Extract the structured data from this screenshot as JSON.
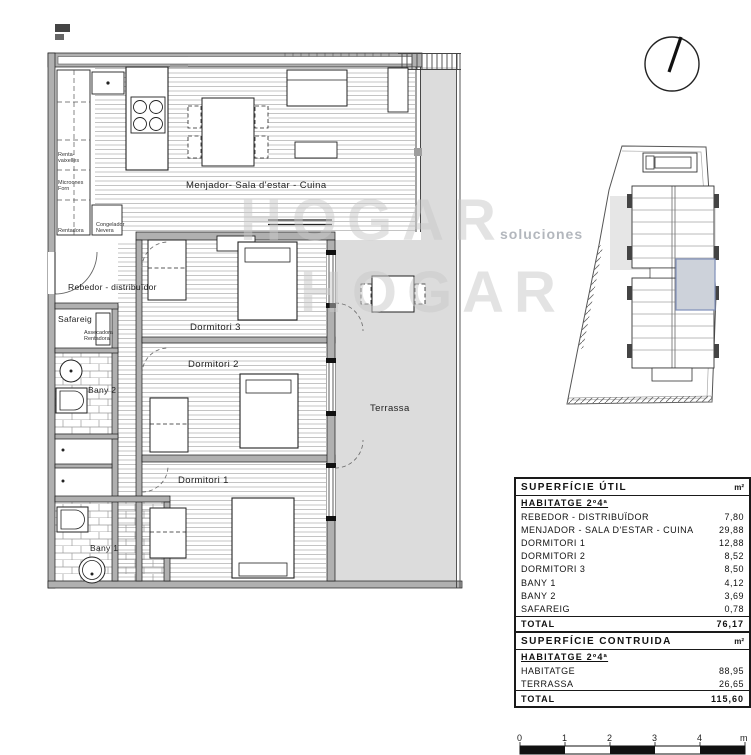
{
  "watermark": {
    "word1": "HOGAR",
    "word2": "HOGAR",
    "small_text": "soluciones"
  },
  "plan": {
    "room_labels": {
      "living": "Menjador- Sala d'estar - Cuina",
      "rebedor": "Rebedor - distribuïdor",
      "safareig": "Safareig",
      "bany1": "Bany 1",
      "bany2": "Bany 2",
      "dormitori1": "Dormitori 1",
      "dormitori2": "Dormitori 2",
      "dormitori3": "Dormitori 3",
      "terrassa": "Terrassa"
    },
    "appliance_labels": {
      "renta_l1": "Renta-",
      "renta_l2": "vaixelles",
      "micro_l1": "Microones",
      "micro_l2": "Forn",
      "rentadora": "Rentadora",
      "congelador_l1": "Congelador",
      "congelador_l2": "Nevera",
      "assecadora_l1": "Assecadora",
      "assecadora_l2": "Rentadora"
    }
  },
  "tables": {
    "util": {
      "title": "SUPERFÍCIE ÚTIL",
      "unit": "m²",
      "subtitle": "HABITATGE 2º4ª",
      "rows": [
        {
          "label": "REBEDOR - DISTRIBUÏDOR",
          "value": "7,80"
        },
        {
          "label": "MENJADOR - SALA D'ESTAR - CUINA",
          "value": "29,88"
        },
        {
          "label": "DORMITORI 1",
          "value": "12,88"
        },
        {
          "label": "DORMITORI 2",
          "value": "8,52"
        },
        {
          "label": "DORMITORI 3",
          "value": "8,50"
        },
        {
          "label": "BANY 1",
          "value": "4,12"
        },
        {
          "label": "BANY 2",
          "value": "3,69"
        },
        {
          "label": "SAFAREIG",
          "value": "0,78"
        }
      ],
      "total_label": "TOTAL",
      "total_value": "76,17"
    },
    "contruida": {
      "title": "SUPERFÍCIE CONTRUIDA",
      "unit": "m²",
      "subtitle": "HABITATGE 2º4ª",
      "rows": [
        {
          "label": "HABITATGE",
          "value": "88,95"
        },
        {
          "label": "TERRASSA",
          "value": "26,65"
        }
      ],
      "total_label": "TOTAL",
      "total_value": "115,60"
    }
  },
  "scale_bar": {
    "labels": [
      "0",
      "1",
      "2",
      "3",
      "4",
      "m"
    ]
  },
  "colors": {
    "terrace_fill": "#dcdcdc",
    "wall_fill": "#b0b0b0",
    "floor_hatch": "#b5b5b5",
    "highlight_fill": "#cdd2da",
    "highlight_stroke": "#7f8fba",
    "watermark": "#c9c9c9"
  }
}
